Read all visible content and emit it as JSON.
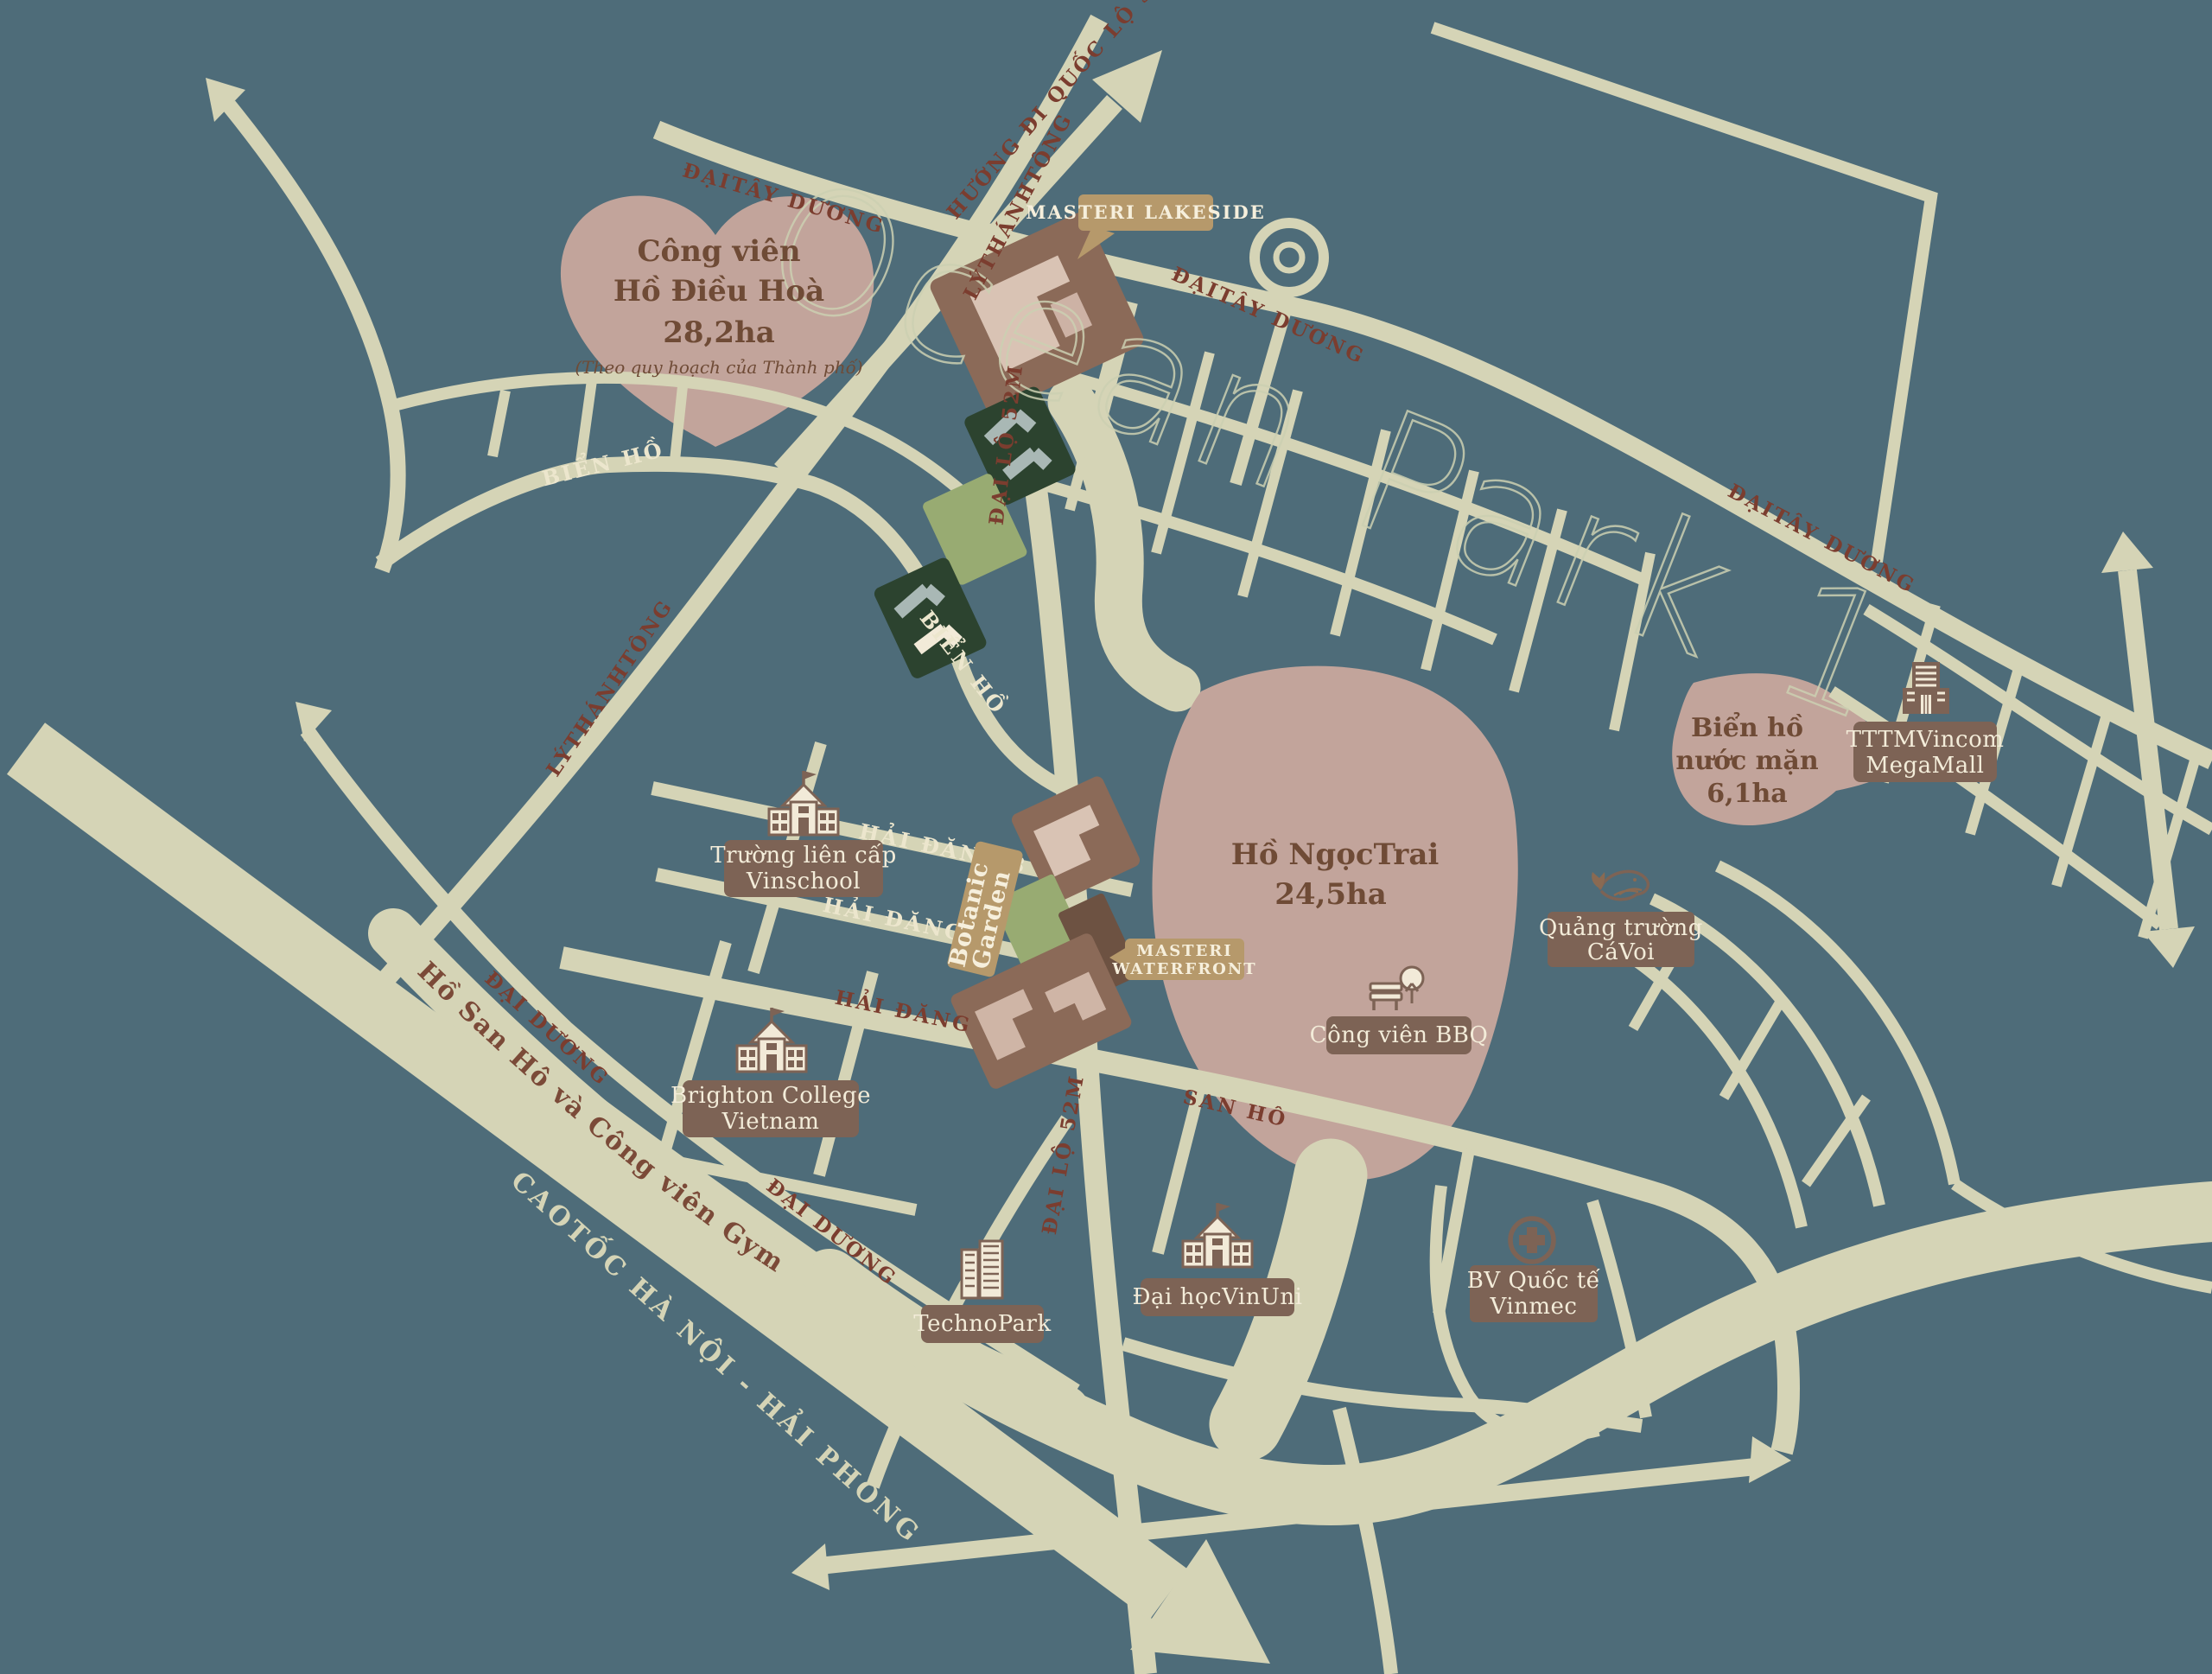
{
  "watermark": "Ocean Park 1",
  "colors": {
    "water_background": "#4e6c79",
    "road": "#d5d4b6",
    "lake_mauve": "#c2a49b",
    "river_pink": "#dbcbc4",
    "label_box_brown": "#7d6355",
    "callout_tan": "#b6996b",
    "road_text_red": "#7b3d2f",
    "lake_text_brown": "#6f4b36",
    "cream_text": "#f3ecd9",
    "parcel_dark_green": "#2c432f",
    "parcel_light_green": "#98ab72",
    "parcel_brown": "#8b6a58"
  },
  "lakes": {
    "dieu_hoa": {
      "line1": "Công viên",
      "line2": "Hồ Điều Hoà",
      "line3": "28,2ha",
      "note": "(Theo quy hoạch của Thành phố)"
    },
    "ngoc_trai": {
      "line1": "Hồ NgọcTrai",
      "line2": "24,5ha"
    },
    "nuoc_man": {
      "line1": "Biển hồ",
      "line2": "nước mặn",
      "line3": "6,1ha"
    },
    "san_ho_gym": {
      "text": "Hồ San Hô và Công viên Gym"
    }
  },
  "callouts": {
    "masteri_lakeside": {
      "text": "MASTERI LAKESIDE"
    },
    "masteri_waterfront": {
      "line1": "MASTERI",
      "line2": "WATERFRONT"
    },
    "botanic_garden": {
      "line1": "Botanic",
      "line2": "Garden"
    }
  },
  "pois": {
    "vinschool": {
      "line1": "Trường liên cấp",
      "line2": "Vinschool",
      "icon": "school-icon"
    },
    "brighton": {
      "line1": "Brighton College",
      "line2": "Vietnam",
      "icon": "school-icon"
    },
    "technopark": {
      "text": "TechnoPark",
      "icon": "office-building-icon"
    },
    "vinuni": {
      "text": "Đại họcVinUni",
      "icon": "university-icon"
    },
    "vinmec": {
      "line1": "BV Quốc tế",
      "line2": "Vinmec",
      "icon": "hospital-cross-icon"
    },
    "bbq_park": {
      "text": "Công viên BBQ",
      "icon": "park-icon"
    },
    "whale_square": {
      "line1": "Quảng trường",
      "line2": "CáVoi",
      "icon": "whale-icon"
    },
    "vincom": {
      "line1": "TTTMVincom",
      "line2": "MegaMall",
      "icon": "mall-icon"
    }
  },
  "road_labels": {
    "ql5a": "HƯỚNG ĐI QUỐC LỘ 5A",
    "ly_thanh_tong": "LÝTHÁNHTÔNG",
    "dai_tay_duong": "ĐẠITÂY DƯƠNG",
    "bien_ho": "BIỂN HỒ",
    "hai_dang_8": "HẢI ĐĂNG 8",
    "hai_dang_5": "HẢI ĐĂNG 5",
    "hai_dang": "HẢI ĐĂNG",
    "san_ho": "SAN HÔ",
    "dai_lo_52m": "ĐẠI LỘ 52M",
    "dai_duong": "ĐẠI DƯƠNG",
    "cao_toc": "CAOTỐC HÀ NỘI - HẢI PHÒNG"
  }
}
